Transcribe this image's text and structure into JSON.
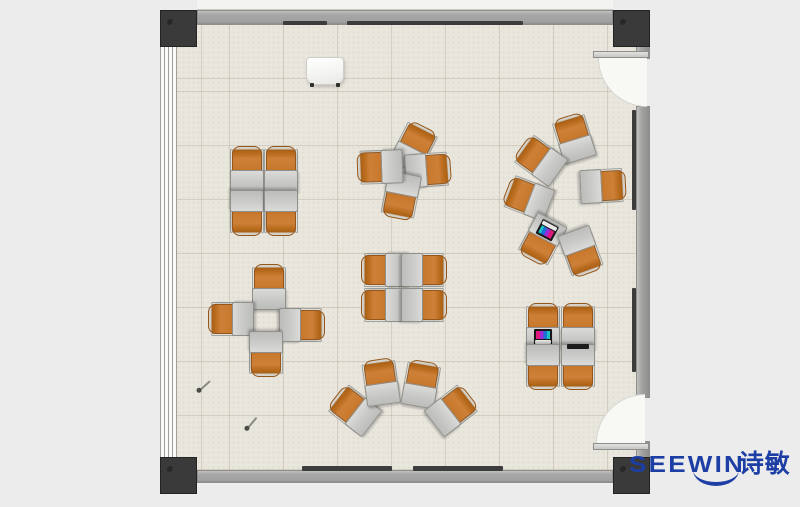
{
  "image": {
    "type": "floor-plan",
    "width": 800,
    "height": 507,
    "background": "#ececec",
    "description": "Top-down rendered floor plan of a classroom furnished with orange tablet-arm chairs and grey desks arranged in clusters"
  },
  "logo": {
    "brand": "SEEWIN",
    "cjk": "诗敏",
    "color": "#1d3fa5"
  },
  "floorplan": {
    "colors": {
      "floor": "#e9e6dd",
      "wall": "#a7a7a7",
      "pillar": "#3a3a3a",
      "chair-orange": "#c97b31",
      "desk-grey": "#cbcbc9",
      "trim-dark": "#3c3c3c",
      "logo-blue": "#1d3fa5"
    },
    "units": [
      {
        "cluster": "quad-nw",
        "x": 247,
        "y": 169,
        "rot": 0
      },
      {
        "cluster": "quad-nw",
        "x": 281,
        "y": 169,
        "rot": 0
      },
      {
        "cluster": "quad-nw",
        "x": 247,
        "y": 213,
        "rot": 180
      },
      {
        "cluster": "quad-nw",
        "x": 281,
        "y": 213,
        "rot": 180
      },
      {
        "cluster": "pinwheel-n",
        "x": 414,
        "y": 147,
        "rot": 27
      },
      {
        "cluster": "pinwheel-n",
        "x": 428,
        "y": 170,
        "rot": 86
      },
      {
        "cluster": "pinwheel-n",
        "x": 401,
        "y": 196,
        "rot": 191
      },
      {
        "cluster": "pinwheel-n",
        "x": 380,
        "y": 167,
        "rot": 268
      },
      {
        "cluster": "circle-e",
        "x": 574,
        "y": 138,
        "rot": -17
      },
      {
        "cluster": "circle-e",
        "x": 540,
        "y": 160,
        "rot": -54
      },
      {
        "cluster": "circle-e",
        "x": 528,
        "y": 198,
        "rot": -69
      },
      {
        "cluster": "circle-e",
        "x": 542,
        "y": 240,
        "rot": -152,
        "acc": "laptop"
      },
      {
        "cluster": "circle-e",
        "x": 581,
        "y": 252,
        "rot": 160
      },
      {
        "cluster": "circle-e",
        "x": 603,
        "y": 186,
        "rot": 87
      },
      {
        "cluster": "quad-c",
        "x": 384,
        "y": 270,
        "rot": -90
      },
      {
        "cluster": "quad-c",
        "x": 424,
        "y": 270,
        "rot": 90
      },
      {
        "cluster": "quad-c",
        "x": 384,
        "y": 305,
        "rot": -90
      },
      {
        "cluster": "quad-c",
        "x": 424,
        "y": 305,
        "rot": 90
      },
      {
        "cluster": "cross-w",
        "x": 269,
        "y": 287,
        "rot": 0
      },
      {
        "cluster": "cross-w",
        "x": 231,
        "y": 319,
        "rot": -90
      },
      {
        "cluster": "cross-w",
        "x": 302,
        "y": 325,
        "rot": 90
      },
      {
        "cluster": "cross-w",
        "x": 266,
        "y": 354,
        "rot": 180
      },
      {
        "cluster": "fan-s",
        "x": 354,
        "y": 410,
        "rot": -52
      },
      {
        "cluster": "fan-s",
        "x": 381,
        "y": 382,
        "rot": -8
      },
      {
        "cluster": "fan-s",
        "x": 421,
        "y": 384,
        "rot": 10
      },
      {
        "cluster": "fan-s",
        "x": 452,
        "y": 410,
        "rot": 52
      },
      {
        "cluster": "quad-se",
        "x": 543,
        "y": 326,
        "rot": 0,
        "acc": "laptop"
      },
      {
        "cluster": "quad-se",
        "x": 578,
        "y": 326,
        "rot": 0
      },
      {
        "cluster": "quad-se",
        "x": 543,
        "y": 367,
        "rot": 180
      },
      {
        "cluster": "quad-se",
        "x": 578,
        "y": 367,
        "rot": 180,
        "acc": "tablet"
      }
    ],
    "objects": [
      {
        "type": "whiteboard",
        "x": 306,
        "y": 57
      },
      {
        "type": "stick",
        "x": 199,
        "y": 390,
        "rot": -42
      },
      {
        "type": "stick",
        "x": 247,
        "y": 428,
        "rot": -50
      }
    ]
  }
}
